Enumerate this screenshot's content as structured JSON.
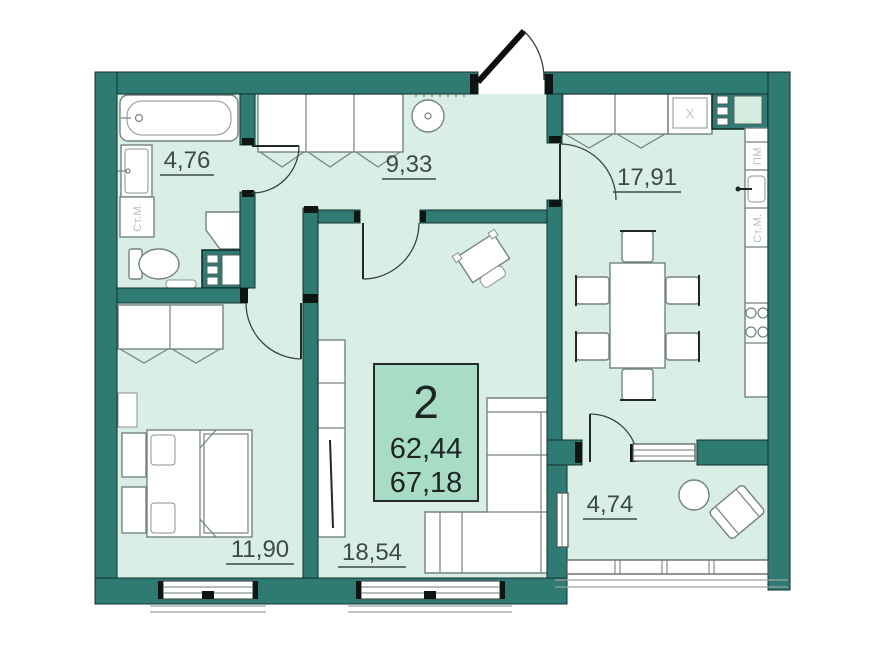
{
  "plan": {
    "unit": {
      "rooms_count": "2",
      "living_area": "62,44",
      "total_area": "67,18"
    },
    "rooms": [
      {
        "id": "bathroom",
        "area": "4,76"
      },
      {
        "id": "hallway",
        "area": "9,33"
      },
      {
        "id": "kitchen-living",
        "area": "17,91"
      },
      {
        "id": "bedroom",
        "area": "11,90"
      },
      {
        "id": "living-room",
        "area": "18,54"
      },
      {
        "id": "balcony",
        "area": "4,74"
      }
    ],
    "appliance_labels": {
      "washer_bath": "Ст.М.",
      "dishwasher": "ПМ",
      "washer_kitchen": "Ст.М.",
      "fridge": "Х"
    },
    "colors": {
      "wall": "#2f7a73",
      "floor": "#d9efe5",
      "label_box": "#a9dcc6",
      "background": "#ffffff",
      "label_text": "#3d4a47"
    }
  }
}
